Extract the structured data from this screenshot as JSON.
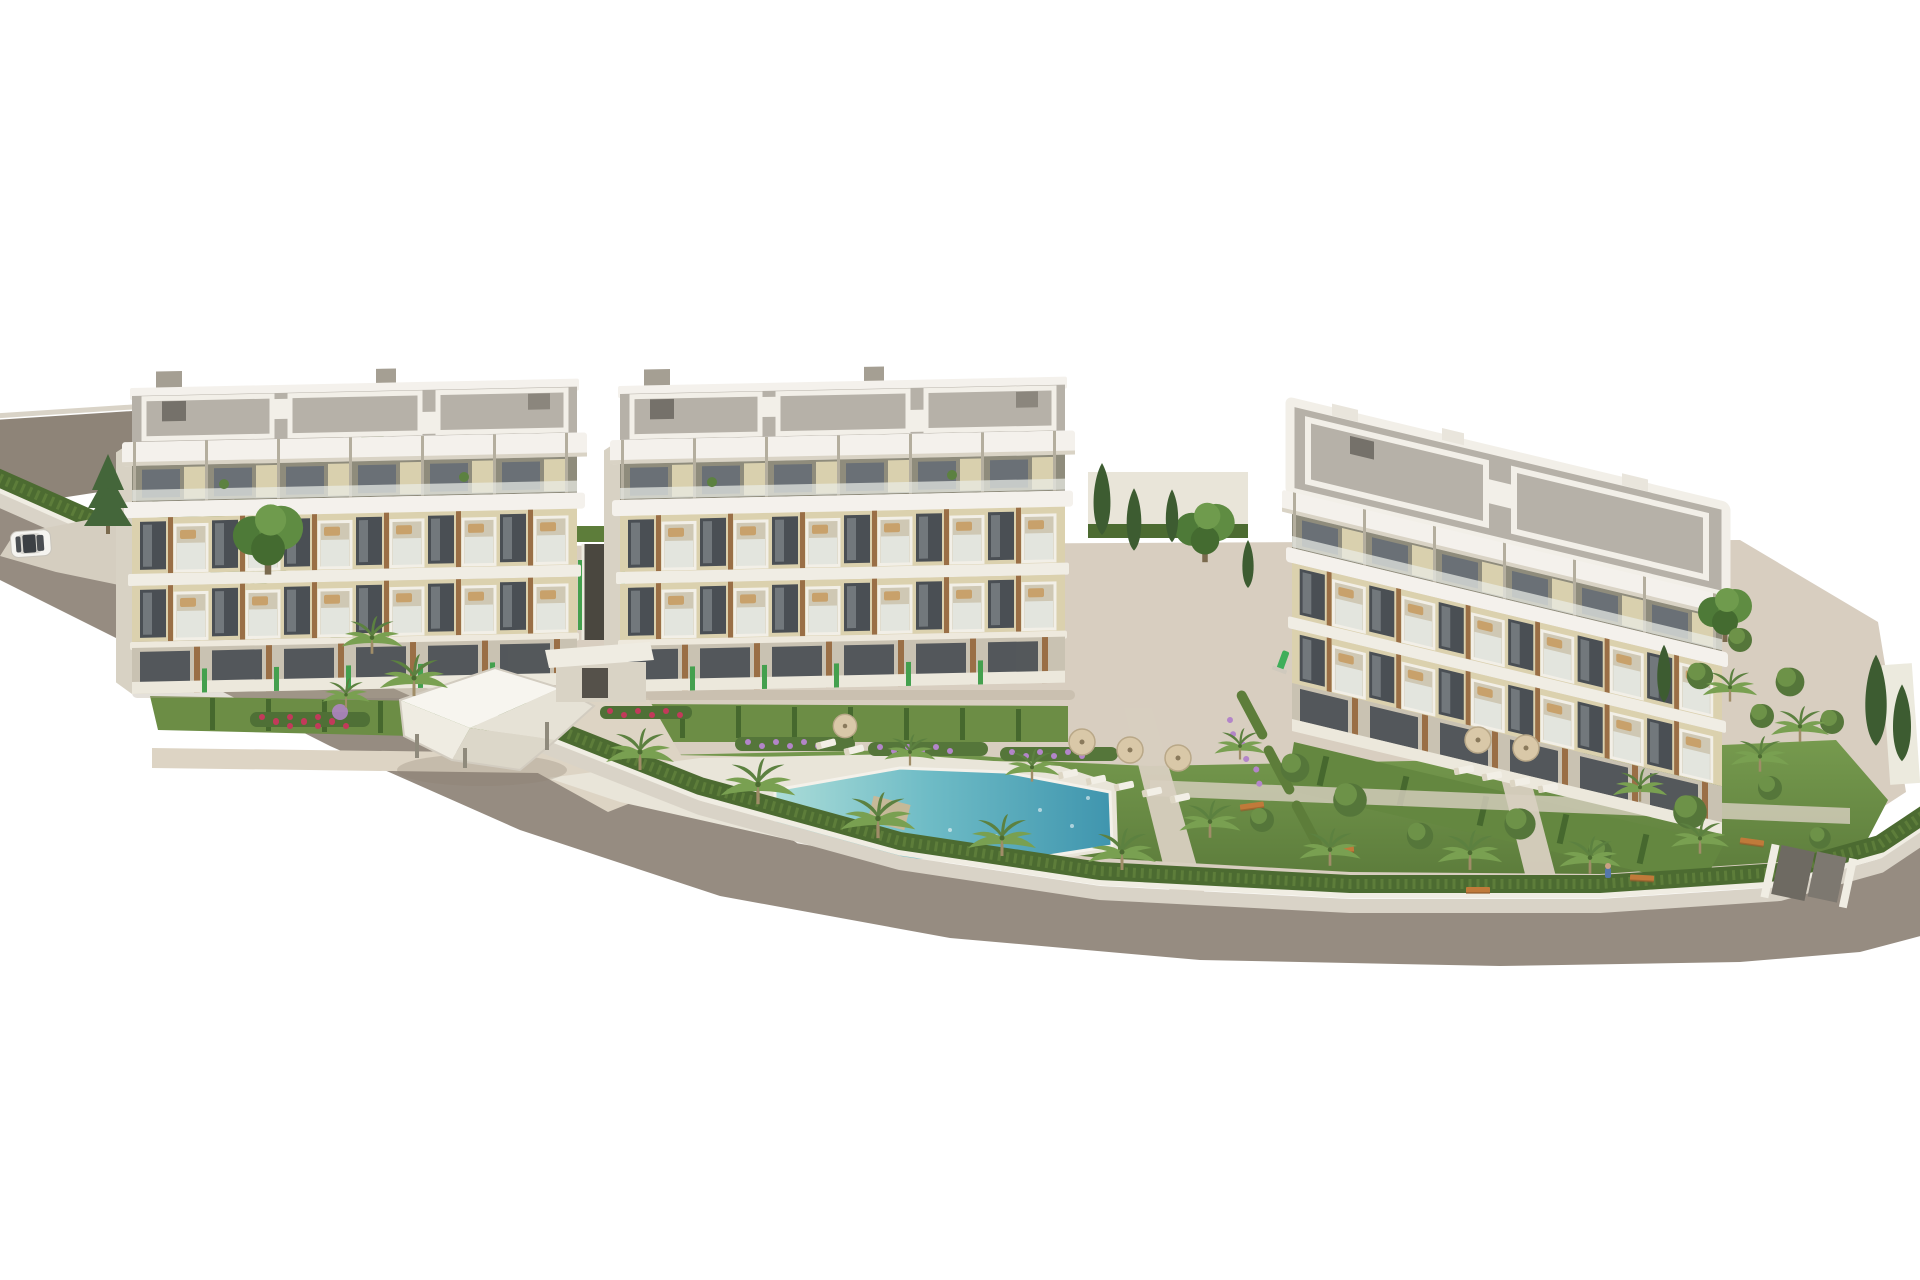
{
  "meta": {
    "width": 1920,
    "height": 1280,
    "description": "Aerial 3D architectural rendering of a modern residential complex: three white four-storey apartment buildings with flat tiled roof decks, cream facades, dark glazing, wood accents and glass balconies, arranged around a landscaped communal garden with a free-form turquoise swimming pool, lawns with parasols and sun loungers, a faceted white pergola lounge, palm and cypress trees, hedged perimeter walls and surrounding grey streets with a single white car."
  },
  "colors": {
    "background": "#ffffff",
    "road_asphalt": "#968c81",
    "road_left": "#8e8478",
    "curb": "#d9d3c7",
    "driveway": "#d5cec0",
    "wall_white": "#f0ede3",
    "hedge_dark": "#4c6b31",
    "hedge_mid": "#5d7d3a",
    "lawn_light": "#769a4e",
    "lawn_dark": "#5d7d3c",
    "garden_green": "#6c8d45",
    "path_beige": "#d8cec0",
    "walk_beige": "#ddd4c4",
    "deck_light": "#e9e5d9",
    "pool_shallow": "#abdcd8",
    "pool_mid": "#6fbcc6",
    "pool_deep": "#3f95ae",
    "pool_stone": "#c9b896",
    "slab_white": "#f4f1ec",
    "slab_shadow": "#d9d3c5",
    "roof_gray": "#b6b1a8",
    "roof_dark": "#75716a",
    "facade_cream": "#dbd1ae",
    "facade_olive": "#8f8c7c",
    "glass_dark": "#4a4f54",
    "glass_mid": "#6a7076",
    "balcony_glass": "#e4e8e2",
    "wood": "#9a6f46",
    "ground_recess": "#c9c2b2",
    "terrace_white": "#ece8dc",
    "fence_green": "#44a04e",
    "palm_green": "#79a051",
    "palm_dark": "#5c8140",
    "cypress_green": "#3d5c31",
    "tree_green": "#5f8c42",
    "shrub_green": "#55763a",
    "umbrella_tan": "#d9c8a8",
    "lounger_white": "#f2efe6",
    "bench_orange": "#c07a3a",
    "flower_purple": "#b385c9",
    "flower_red": "#c23a5a",
    "car_white": "#f5f4f0",
    "ramp_dark": "#4a473f",
    "shadow_warm": "#b3a791"
  },
  "scene": {
    "type": "3d-architectural-rendering",
    "view": "aerial-oblique",
    "buildings": [
      {
        "id": "building-1",
        "position": "left",
        "floors": 4,
        "roof": "flat tiled deck with chimneys and white parapet frames"
      },
      {
        "id": "building-2",
        "position": "center",
        "floors": 4,
        "roof": "flat tiled deck with chimneys and white parapet frames"
      },
      {
        "id": "building-3",
        "position": "right",
        "floors": 4,
        "roof": "flat tiled deck with white parapet grid",
        "orientation": "rotated, facade sloping down to the right"
      }
    ],
    "amenities": [
      "swimming-pool",
      "pool-deck",
      "pergola-lounge",
      "entry-pavilion",
      "garage-ramp",
      "sun-loungers",
      "parasols",
      "garden-benches",
      "playground-slide",
      "perimeter-hedge",
      "gated-corner-entrance"
    ],
    "vegetation": {
      "palm_trees": 20,
      "cypress_trees": 7,
      "round_shrubs": 14,
      "flower_beds": [
        "purple",
        "red"
      ],
      "lawns": "communal gardens"
    },
    "vehicles": [
      {
        "type": "suv",
        "color": "white",
        "location": "north-west street"
      }
    ],
    "counts": {
      "sun_loungers": 11,
      "parasols": 6,
      "benches": 5
    }
  }
}
